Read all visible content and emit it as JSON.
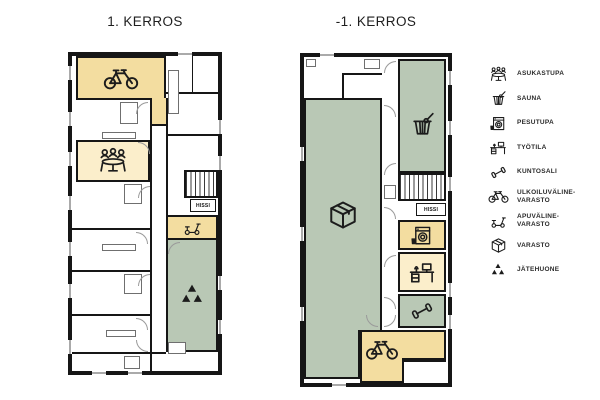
{
  "poster": {
    "background": "#ffffff"
  },
  "colors": {
    "wall": "#161616",
    "accent_tan": "#f3dda0",
    "accent_tan_light": "#fbeecb",
    "accent_green": "#b9c8b5",
    "line": "#6f6f6f",
    "door": "#9a9a9a"
  },
  "plans": [
    {
      "title": "1. KERROS",
      "elevator_label": "HISSI",
      "rooms": [
        {
          "name": "ulkoiluvaline-varasto",
          "icon": "bicycle"
        },
        {
          "name": "asukastupa",
          "icon": "residents-lounge"
        },
        {
          "name": "apuvaline-varasto",
          "icon": "mobility-aid"
        },
        {
          "name": "jatehuone",
          "icon": "recycling"
        }
      ]
    },
    {
      "title": "-1. KERROS",
      "elevator_label": "HISSI",
      "rooms": [
        {
          "name": "varasto",
          "icon": "storage-box"
        },
        {
          "name": "sauna",
          "icon": "sauna"
        },
        {
          "name": "pesutupa",
          "icon": "washing-machine"
        },
        {
          "name": "tyotila",
          "icon": "desk"
        },
        {
          "name": "kuntosali",
          "icon": "dumbbell"
        },
        {
          "name": "ulkoiluvaline-varasto",
          "icon": "bicycle"
        }
      ]
    }
  ],
  "legend": {
    "items": [
      {
        "icon": "residents-lounge-icon",
        "label": "ASUKASTUPA"
      },
      {
        "icon": "sauna-icon",
        "label": "SAUNA"
      },
      {
        "icon": "washing-machine-icon",
        "label": "PESUTUPA"
      },
      {
        "icon": "desk-icon",
        "label": "TYÖTILA"
      },
      {
        "icon": "dumbbell-icon",
        "label": "KUNTOSALI"
      },
      {
        "icon": "bicycle-icon",
        "label": "ULKOILUVÄLINE-\nVARASTO"
      },
      {
        "icon": "mobility-aid-icon",
        "label": "APUVÄLINE-\nVARASTO"
      },
      {
        "icon": "storage-box-icon",
        "label": "VARASTO"
      },
      {
        "icon": "recycling-icon",
        "label": "JÄTEHUONE"
      }
    ]
  }
}
